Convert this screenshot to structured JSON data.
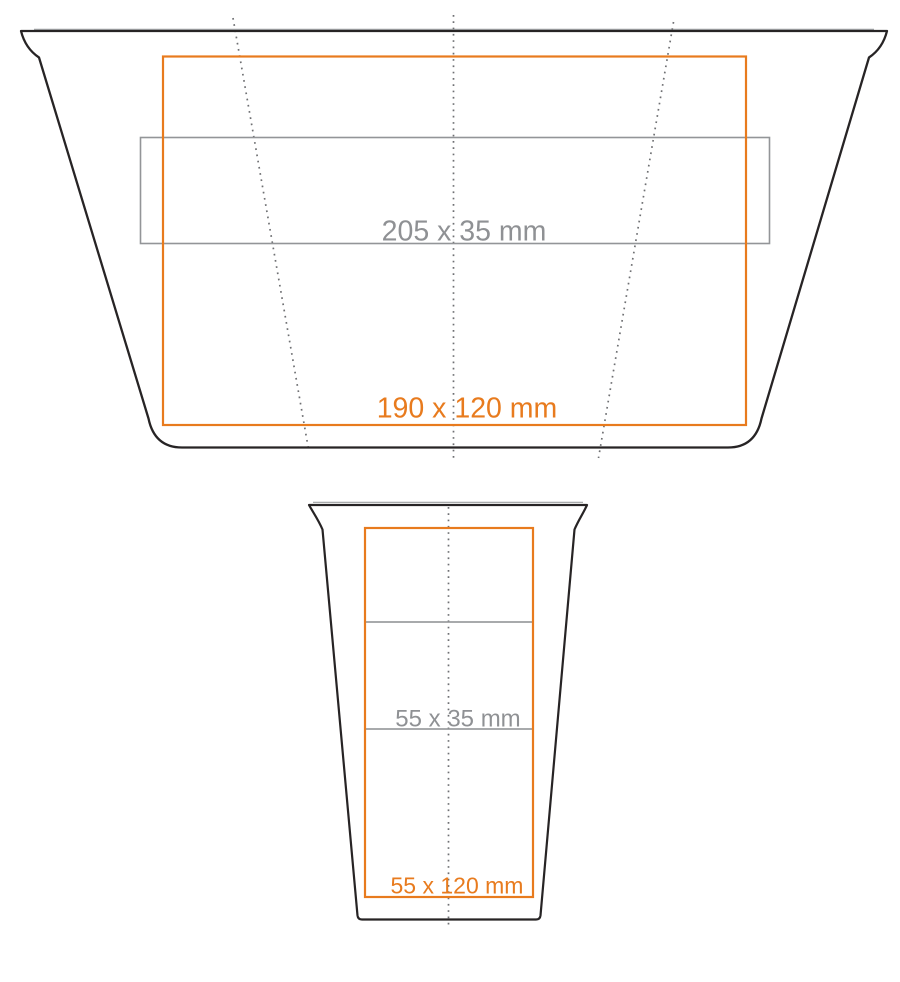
{
  "labels": {
    "flattened_wrap_area": "205 x 35 mm",
    "flattened_print_area": "190 x 120 mm",
    "side_wrap_area": "55 x 35 mm",
    "side_print_area": "55 x 120 mm"
  },
  "colors": {
    "outline_black": "#272425",
    "rim_gray": "#9d9fa1",
    "print_area_orange": "#e87b1e",
    "wrap_area_gray": "#939598",
    "label_gray": "#8f9194",
    "guide_dot_gray": "#6f7073",
    "background": "#ffffff"
  }
}
